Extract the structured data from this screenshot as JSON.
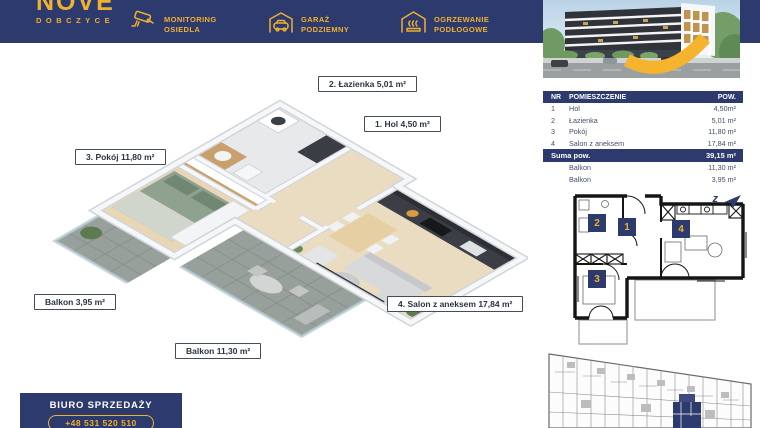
{
  "brand": {
    "name": "NOVE",
    "city": "DOBCZYCE"
  },
  "header": {
    "features": [
      {
        "icon": "cctv-camera-icon",
        "line1": "MONITORING",
        "line2": "OSIEDLA"
      },
      {
        "icon": "garage-car-icon",
        "line1": "GARAŻ",
        "line2": "PODZIEMNY"
      },
      {
        "icon": "underfloor-heating-icon",
        "line1": "OGRZEWANIE",
        "line2": "PODŁOGOWE"
      }
    ]
  },
  "plan_labels": [
    {
      "text": "2. Łazienka 5,01 m²"
    },
    {
      "text": "1. Hol 4,50 m²"
    },
    {
      "text": "3. Pokój 11,80 m²"
    },
    {
      "text": "Balkon 3,95 m²"
    },
    {
      "text": "4. Salon z aneksem 17,84 m²"
    },
    {
      "text": "Balkon 11,30 m²"
    }
  ],
  "table": {
    "headers": {
      "nr": "NR",
      "room": "POMIESZCZENIE",
      "area": "POW."
    },
    "rows": [
      {
        "nr": "1",
        "room": "Hol",
        "area": "4,50m²"
      },
      {
        "nr": "2",
        "room": "Łazienka",
        "area": "5,01 m²"
      },
      {
        "nr": "3",
        "room": "Pokój",
        "area": "11,80 m²"
      },
      {
        "nr": "4",
        "room": "Salon z aneksem",
        "area": "17,84 m²"
      }
    ],
    "summary": {
      "label": "Suma pow.",
      "area": "39,15 m²"
    },
    "extras": [
      {
        "room": "Balkon",
        "area": "11,30 m²"
      },
      {
        "room": "Balkon",
        "area": "3,95 m²"
      }
    ]
  },
  "schematic": {
    "badges": {
      "b1": "1",
      "b2": "2",
      "b3": "3",
      "b4": "4"
    },
    "compass_letter": "z"
  },
  "sales_office": {
    "title": "BIURO SPRZEDAŻY",
    "phone": "+48 531 520 510"
  },
  "colors": {
    "navy": "#2d3a6e",
    "gold": "#f0b030",
    "swoosh": "#f6b42e"
  }
}
